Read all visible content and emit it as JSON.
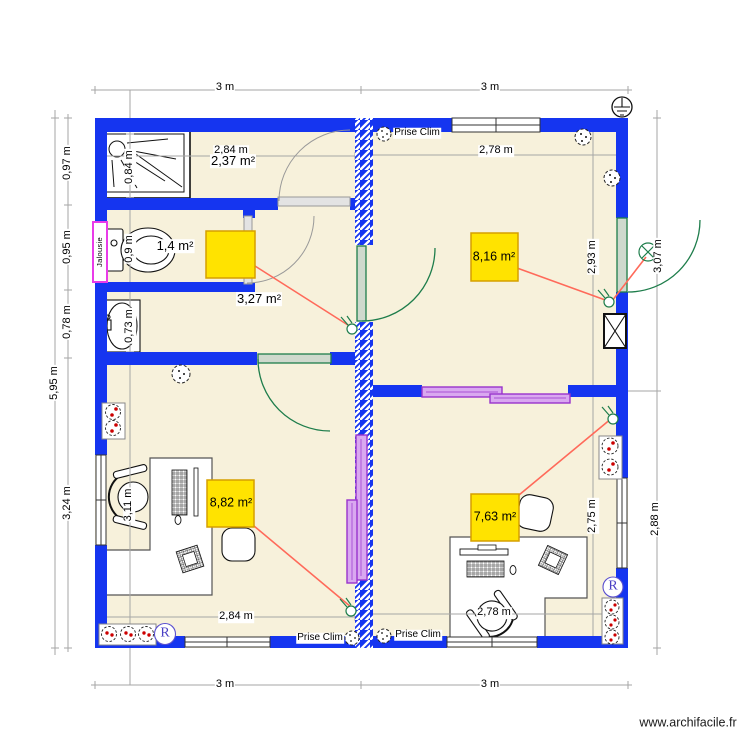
{
  "dims": {
    "top_left_3m": "3 m",
    "top_right_3m": "3 m",
    "bottom_left_3m": "3 m",
    "bottom_right_3m": "3 m",
    "height_total": "5,95 m",
    "left_seg1": "0,97 m",
    "left_seg2": "0,95 m",
    "left_seg3": "0,78 m",
    "left_seg4": "3,24 m",
    "inner_shower": "0,84 m",
    "inner_wc": "0,9 m",
    "inner_sink": "0,73 m",
    "inner_office_left": "3,11 m",
    "room_tl_width": "2,84 m",
    "room_tr_width": "2,78 m",
    "room_bl_width": "2,84 m",
    "room_br_width": "2,78 m",
    "right_inner_top": "2,93 m",
    "right_inner_bottom": "2,75 m",
    "right_outer_top": "3,07 m",
    "right_outer_bottom": "2,88 m"
  },
  "areas": {
    "shower_room": "2,37 m²",
    "wc": "1,4 m²",
    "hall": "3,27 m²",
    "office_top_right": "8,16 m²",
    "office_bottom_left": "8,82 m²",
    "office_bottom_right": "7,63 m²"
  },
  "labels": {
    "prise_clim": "Prise Clim",
    "jalousie": "Jalousie",
    "network_plug": "R",
    "watermark": "www.archifacile.fr"
  },
  "icons": [
    "shower-icon",
    "toilet-icon",
    "sink-icon",
    "desk-icon",
    "office-chair-icon",
    "guest-chair-icon",
    "monitor-icon",
    "keyboard-icon",
    "socket-icon",
    "double-socket-icon",
    "clim-socket-icon",
    "switch-icon",
    "ceiling-lamp-icon",
    "earth-ground-icon",
    "network-socket-icon",
    "duct-icon"
  ],
  "colors": {
    "wall": "#1535F0",
    "floor": "#F7F1DB",
    "area_box_fill": "#FFE300",
    "area_box_border": "#D59F00",
    "door": "#1E7D4B",
    "sliding_door": "#9933CC",
    "wire": "#FF6A5A",
    "jalousie_frame": "#E93BE9",
    "dimension_line": "#A6A6A6",
    "socket_dot": "#CC0000"
  }
}
